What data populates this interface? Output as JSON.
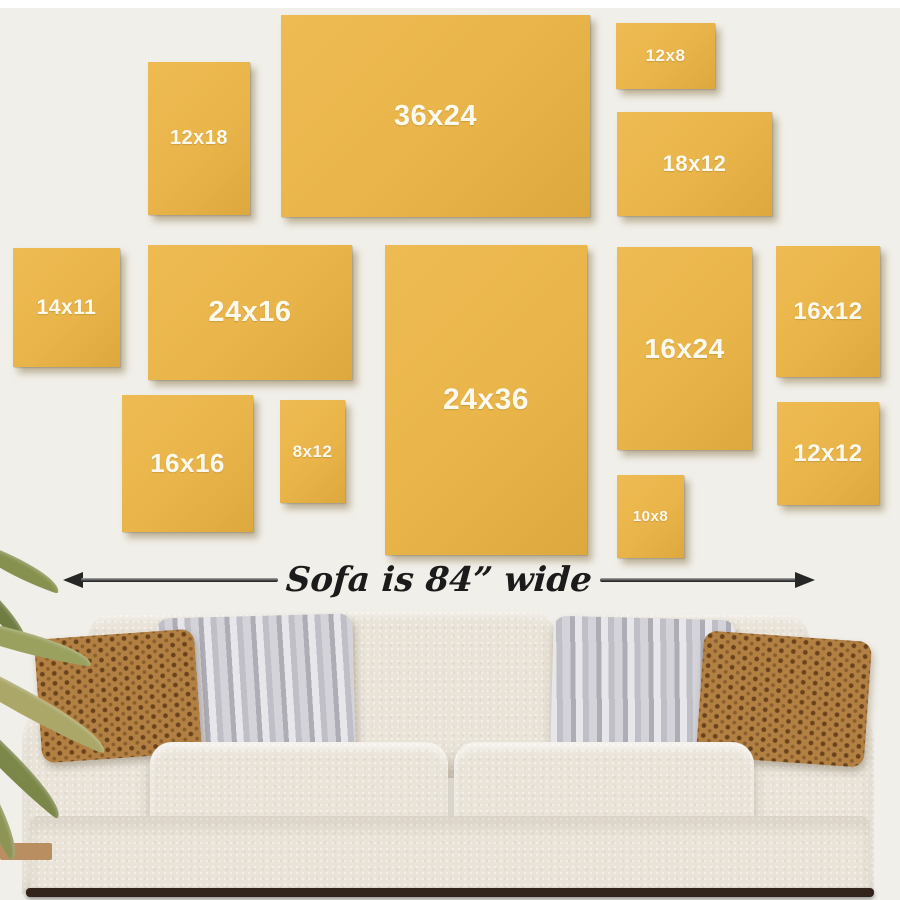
{
  "scene": {
    "type": "canvas-size-guide",
    "caption": "Sofa is 84” wide",
    "wall_color": "#f1efe9",
    "canvas_color": "#e9b54a",
    "label_color": "#fcf9ef",
    "sofa_color": "#e9e3d8",
    "pillow_brown_color": "#b28043",
    "pillow_gray_color": "#c9c8cf"
  },
  "canvases": [
    {
      "label": "12x18"
    },
    {
      "label": "36x24"
    },
    {
      "label": "12x8"
    },
    {
      "label": "18x12"
    },
    {
      "label": "14x11"
    },
    {
      "label": "24x16"
    },
    {
      "label": "16x24"
    },
    {
      "label": "16x12"
    },
    {
      "label": "16x16"
    },
    {
      "label": "8x12"
    },
    {
      "label": "24x36"
    },
    {
      "label": "10x8"
    },
    {
      "label": "12x12"
    }
  ]
}
